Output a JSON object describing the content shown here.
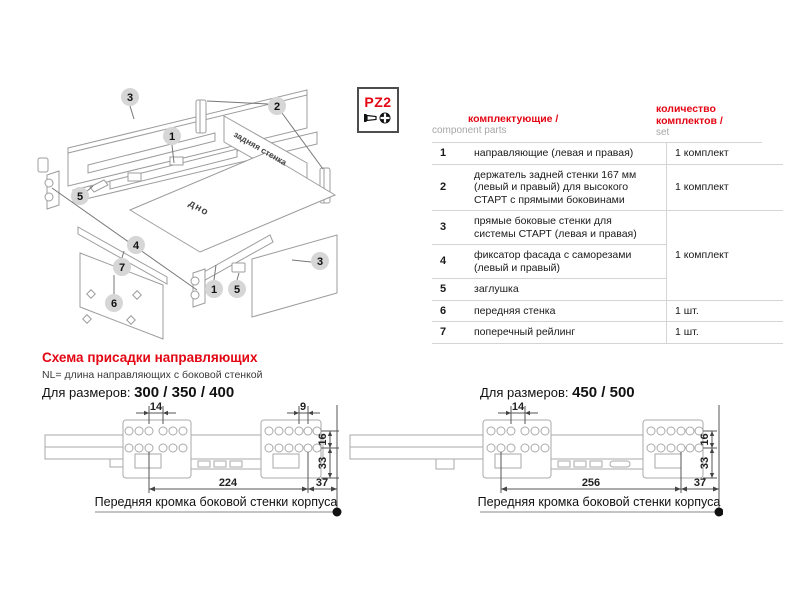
{
  "exploded_diagram": {
    "back_wall_label": "задняя стенка",
    "bottom_panel_label": "дно",
    "callouts": {
      "wall_left": "3",
      "rail_left": "1",
      "holders": "2",
      "plug_left": "5",
      "fixator": "4",
      "railing": "7",
      "front_panel": "6",
      "rail_right": "1",
      "plug_right": "5",
      "wall_right": "3"
    }
  },
  "tool_badge": {
    "label": "PZ2"
  },
  "parts_table": {
    "header": {
      "col_parts_ru": "комплектующие /",
      "col_parts_en": "component parts",
      "col_qty_ru": "количество комплектов /",
      "col_qty_en": "set"
    },
    "rows": [
      {
        "num": "1",
        "desc": "направляющие (левая и правая)",
        "qty": "1 комплект"
      },
      {
        "num": "2",
        "desc": "держатель задней стенки 167 мм (левый и правый) для высокого СТАРТ с прямыми боковинами",
        "qty": "1 комплект"
      },
      {
        "num": "3",
        "desc": "прямые боковые стенки для системы СТАРТ (левая и правая)",
        "qty": "1 комплект"
      },
      {
        "num": "4",
        "desc": "фиксатор фасада с саморезами (левый и правый)",
        "qty": ""
      },
      {
        "num": "5",
        "desc": "заглушка",
        "qty": ""
      },
      {
        "num": "6",
        "desc": "передняя стенка",
        "qty": "1 шт."
      },
      {
        "num": "7",
        "desc": "поперечный рейлинг",
        "qty": "1 шт."
      }
    ]
  },
  "drilling_section": {
    "heading": "Схема присадки направляющих",
    "note": "NL= длина направляющих с боковой стенкой",
    "left_drawing": {
      "title_prefix": "Для размеров:",
      "sizes": "300 / 350 / 400",
      "dims": {
        "top_left": "14",
        "top_right": "9",
        "right_upper": "16",
        "right_lower": "33",
        "bottom_main": "224",
        "bottom_offset": "37"
      },
      "caption": "Передняя кромка боковой стенки корпуса"
    },
    "right_drawing": {
      "title_prefix": "Для размеров:",
      "sizes": "450 / 500",
      "dims": {
        "top_left": "14",
        "right_upper": "16",
        "right_lower": "33",
        "bottom_main": "256",
        "bottom_offset": "37"
      },
      "caption": "Передняя кромка боковой стенки корпуса"
    }
  },
  "colors": {
    "accent_red": "#e30613",
    "muted_gray": "#a6a6a6",
    "table_line": "#d4d4d4",
    "drawing_gray": "#aaaaaa"
  }
}
